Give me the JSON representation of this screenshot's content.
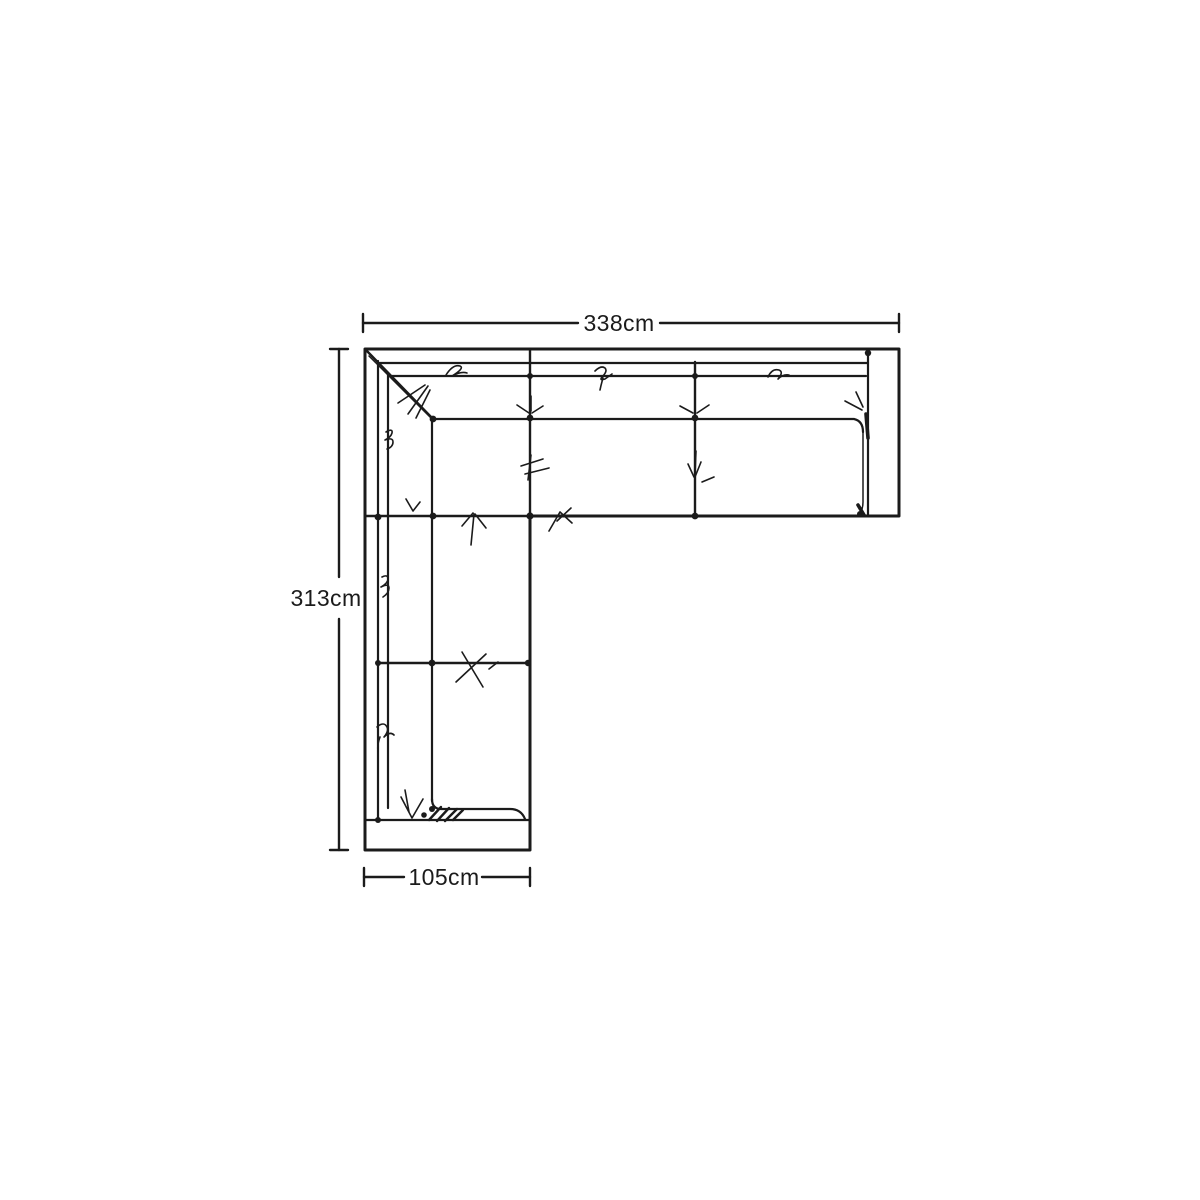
{
  "page": {
    "background_color": "#ffffff"
  },
  "diagram": {
    "title": "Corner sofa top-view dimension drawing",
    "type": "furniture-floorplan-line-drawing",
    "subject": "L-shaped corner sofa seen from above",
    "line_color": "#1b1b1b"
  },
  "dimensions": {
    "top": {
      "label": "338cm",
      "value_cm": 338,
      "orientation": "horizontal"
    },
    "left": {
      "label": "313cm",
      "value_cm": 313,
      "orientation": "vertical"
    },
    "bottom": {
      "label": "105cm",
      "value_cm": 105,
      "orientation": "horizontal"
    }
  }
}
